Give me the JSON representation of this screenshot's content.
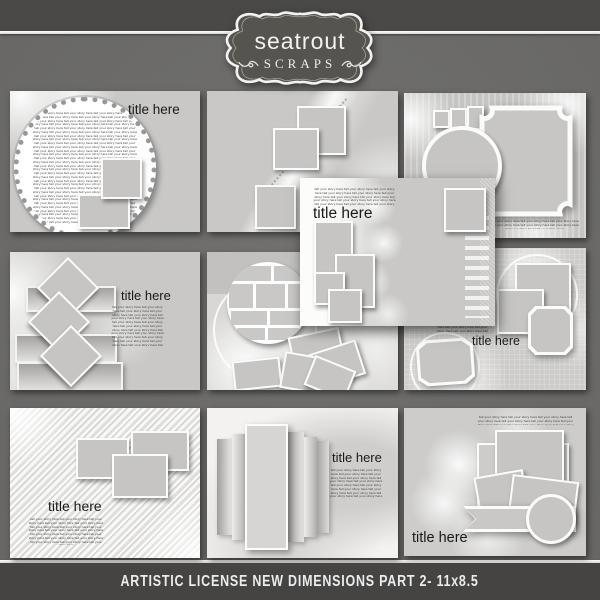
{
  "badge": {
    "brand": "seatrout",
    "subtitle": "SCRAPS"
  },
  "footer": {
    "caption": "ARTISTIC LICENSE NEW DIMENSIONS PART 2- 11x8.5"
  },
  "filler_phrase": "tell your story here ",
  "templates": {
    "top_left": {
      "title": "title here"
    },
    "top_middle": {},
    "top_right": {},
    "middle_left": {
      "title": "title here"
    },
    "middle_center": {},
    "middle_right": {
      "title": "title here"
    },
    "bottom_left": {
      "title": "title here"
    },
    "bottom_middle": {
      "title": "title here"
    },
    "bottom_right": {
      "title": "title here"
    },
    "overlay": {
      "title": "title here"
    }
  },
  "colors": {
    "top_strip": "#4a4947",
    "canvas": "#6f6e6c",
    "bottom_strip": "#454443",
    "divider_line": "#f2f2f2",
    "page": "#c9c8c6",
    "badge_fill": "#56544f",
    "badge_border": "#f2f2f2",
    "title_text": "#1a1a1a",
    "caption_text": "#ececec"
  }
}
